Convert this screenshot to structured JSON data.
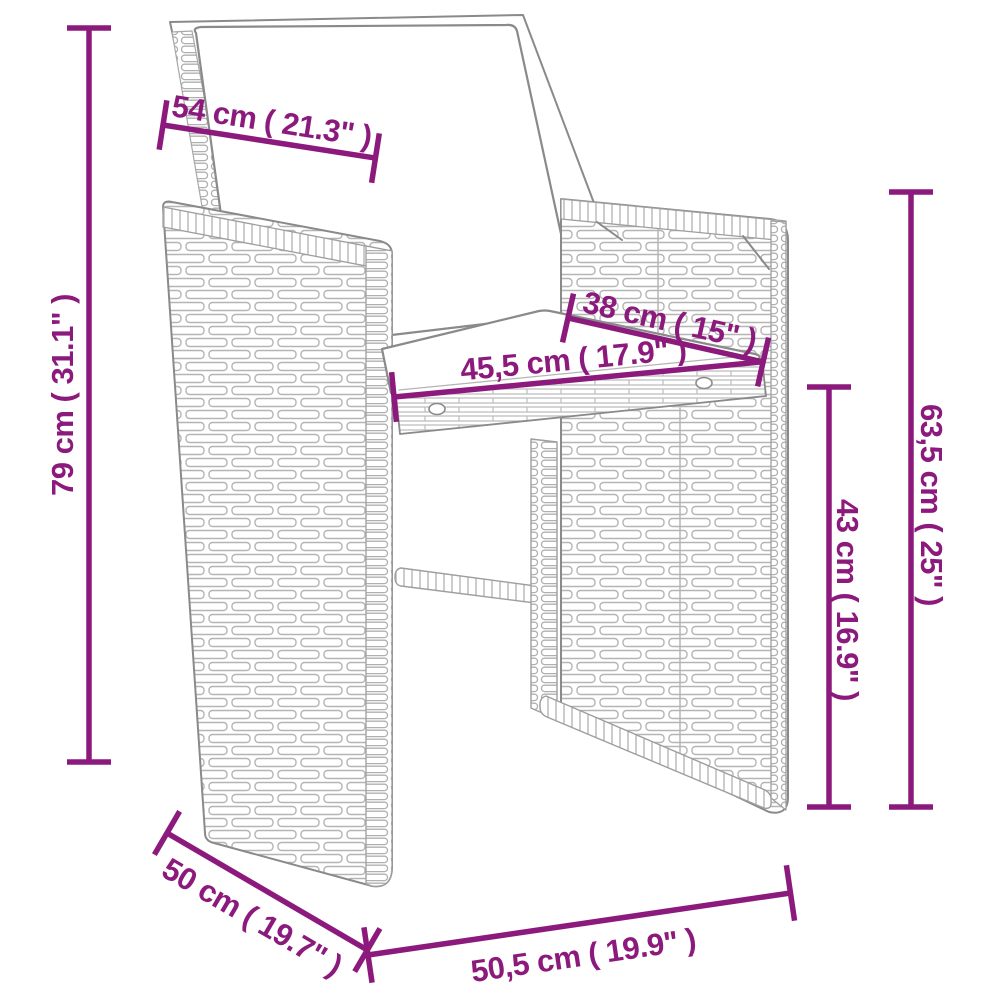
{
  "diagram": {
    "accent_color": "#8c1a7d",
    "artwork_line_color": "#8a8a8a",
    "dimensions": {
      "back_width": "54 cm ( 21.3\" )",
      "total_height": "79 cm ( 31.1\" )",
      "seat_depth": "38 cm ( 15\" )",
      "seat_width": "45,5 cm ( 17.9\" )",
      "armrest_height": "63,5 cm ( 25\" )",
      "seat_height": "43 cm ( 16.9\" )",
      "base_depth": "50 cm ( 19.7\" )",
      "base_width": "50,5 cm ( 19.9\" )"
    }
  }
}
